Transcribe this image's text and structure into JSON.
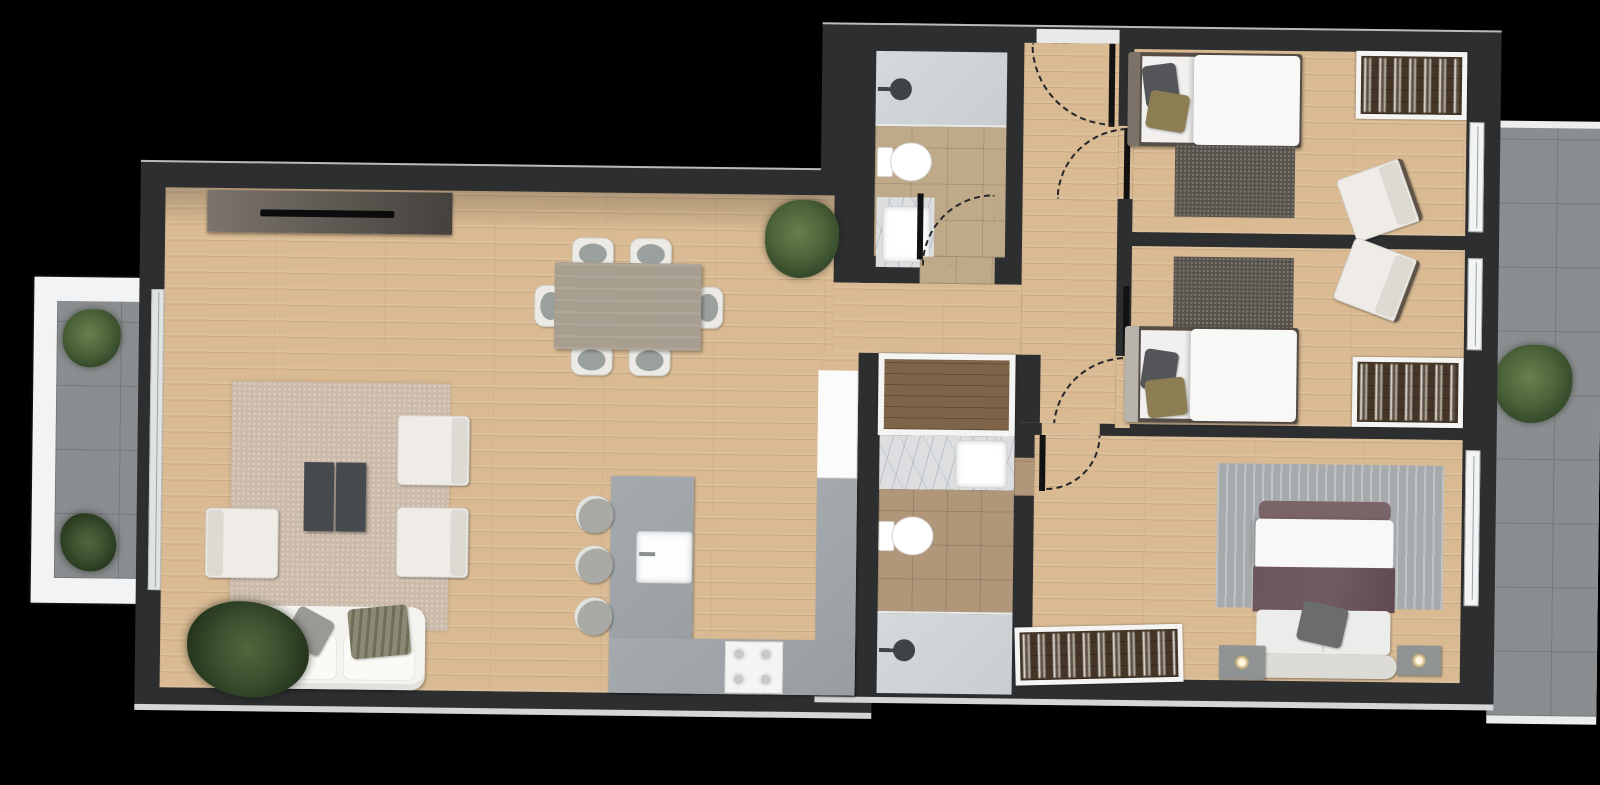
{
  "meta": {
    "title": "Apartment floor plan — top-down 3D render",
    "description": "Rendered plan of a 3-bedroom, 2-bathroom apartment with left balcony and right terrace",
    "canvas": {
      "width": 1600,
      "height": 785
    }
  },
  "palette": {
    "background": "#000000",
    "wall": "#2d2e30",
    "wood_floor": "#d9ba92",
    "kitchen_counter": "#979da1",
    "bath1_tile": "#bea989",
    "bath2_tile": "#b0977a",
    "shower_floor": "#c9ced1",
    "marble": "#dcdee0",
    "terrace_tile": "#8b8e90",
    "balcony_frame": "#f2f3f4",
    "rug_living": "#ccbbaa",
    "rug_bedroom": "#57514b",
    "rug_master": "#a7aaac",
    "dining_table": "#a89e90",
    "coffee_table": "#46494d",
    "wardrobe_interior": "#443526",
    "plant_green": "#445c33",
    "bed_olive_pillow": "#8c7d52",
    "bed_mauve_blanket": "#715a61"
  },
  "rooms": {
    "living": {
      "label": "Living room",
      "furniture": [
        "tv-console",
        "tv",
        "area-rug",
        "coffee-table",
        "armchair x3",
        "sofa",
        "floor-plant"
      ]
    },
    "dining": {
      "label": "Dining area",
      "furniture": [
        "dining-table",
        "dining-chair x6",
        "corner-plant"
      ]
    },
    "kitchen": {
      "label": "Kitchen",
      "furniture": [
        "u-shaped-counter",
        "sink",
        "cooktop-4-burner",
        "tall-fridge-unit",
        "bar-stool x3"
      ]
    },
    "bath1": {
      "label": "Bathroom 1",
      "furniture": [
        "walk-in-shower",
        "toilet",
        "marble-vanity"
      ]
    },
    "bath2": {
      "label": "Bathroom 2 (ensuite)",
      "furniture": [
        "storage-closet",
        "marble-vanity",
        "toilet",
        "walk-in-shower"
      ]
    },
    "hallway": {
      "label": "Entrance hallway",
      "furniture": [
        "entry-door"
      ]
    },
    "bedroom1": {
      "label": "Bedroom 1",
      "furniture": [
        "single-bed",
        "open-wardrobe",
        "rug",
        "armchair"
      ]
    },
    "bedroom2": {
      "label": "Bedroom 2",
      "furniture": [
        "single-bed",
        "open-wardrobe",
        "rug",
        "armchair"
      ]
    },
    "master": {
      "label": "Master bedroom",
      "furniture": [
        "double-bed",
        "nightstand x2",
        "lamp x2",
        "rug",
        "open-wardrobe"
      ]
    },
    "balcony": {
      "label": "Balcony (left)",
      "furniture": [
        "planter x2",
        "sliding-door"
      ]
    },
    "terrace": {
      "label": "Terrace (right)",
      "furniture": [
        "shrub"
      ]
    }
  },
  "counts": {
    "bedrooms": 3,
    "bathrooms": 2,
    "balconies": 2,
    "doors_with_swing_arcs": 5,
    "windows_right_wall": 3
  }
}
